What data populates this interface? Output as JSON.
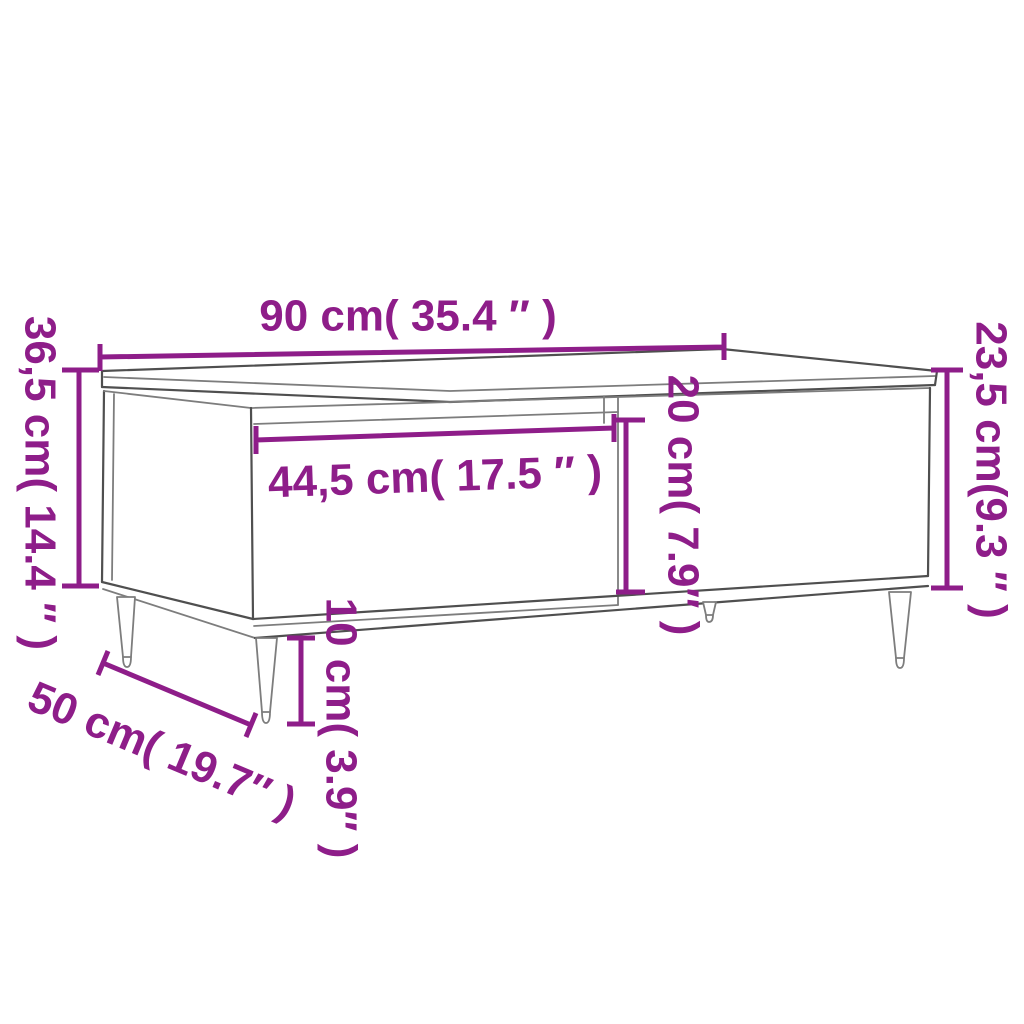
{
  "diagram": {
    "colors": {
      "dimension": "#8E1D89",
      "outline_primary": "#4f4f4f",
      "outline_secondary": "#7d7d7d",
      "background": "#ffffff"
    },
    "dimensions": {
      "width": {
        "label": "90 cm( 35.4 ″ )"
      },
      "height_left": {
        "label": "36,5 cm( 14.4 ″ )"
      },
      "height_right": {
        "label": "23,5 cm(9.3 ″ )"
      },
      "drawer_width": {
        "label": "44,5 cm( 17.5 ″ )"
      },
      "drawer_height": {
        "label": "20 cm( 7.9″ )"
      },
      "depth": {
        "label": "50 cm( 19.7″ )"
      },
      "leg_height": {
        "label": "10 cm( 3.9″ )"
      }
    }
  }
}
